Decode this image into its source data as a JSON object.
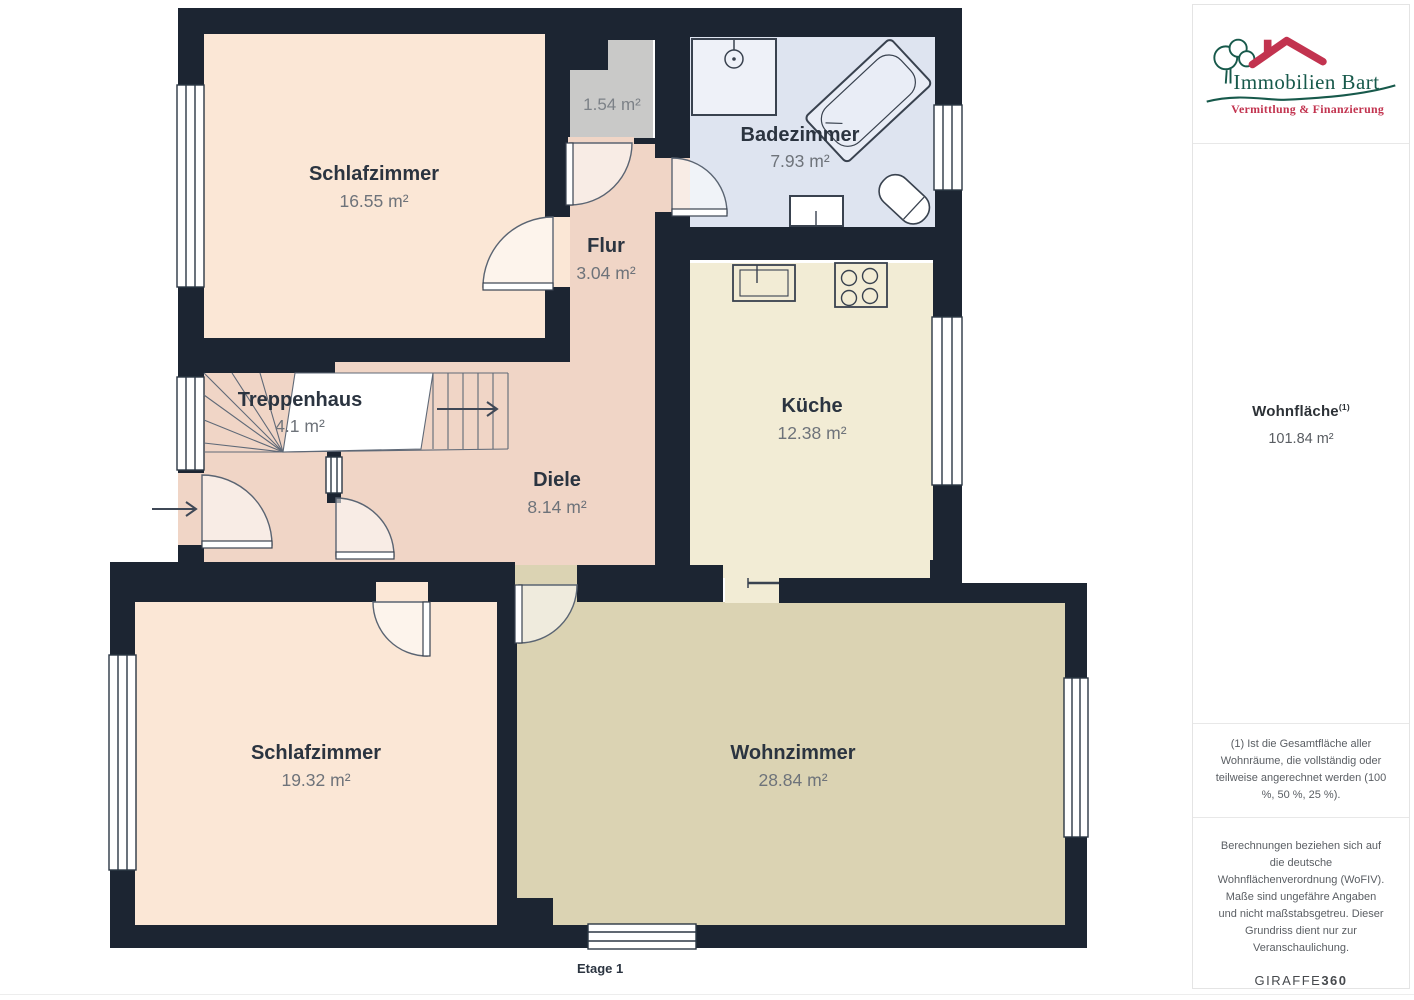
{
  "floorplan": {
    "floor_label": "Etage 1",
    "rooms": [
      {
        "name": "Schlafzimmer",
        "area": "16.55 m²"
      },
      {
        "name": "Badezimmer",
        "area": "7.93 m²"
      },
      {
        "name": "Flur",
        "area": "3.04 m²"
      },
      {
        "name": "Treppenhaus",
        "area": "4.1 m²"
      },
      {
        "name": "Diele",
        "area": "8.14 m²"
      },
      {
        "name": "Küche",
        "area": "12.38 m²"
      },
      {
        "name": "Schlafzimmer",
        "area": "19.32 m²"
      },
      {
        "name": "Wohnzimmer",
        "area": "28.84 m²"
      },
      {
        "name": "",
        "area": "1.54 m²"
      }
    ],
    "colors": {
      "wall": "#1c2532",
      "bedroom_floor": "#fbe7d6",
      "hallway_floor": "#f0d5c6",
      "bathroom_floor": "#dee4f0",
      "kitchen_floor": "#f2ecd5",
      "living_floor": "#dbd3b3",
      "storage_floor": "#c9c9c8"
    }
  },
  "sidebar": {
    "logo": {
      "brand": "Immobilien Bart",
      "tagline": "Vermittlung & Finanzierung",
      "brand_color": "#17594b",
      "accent_color": "#c2334f"
    },
    "summary": {
      "label": "Wohnfläche",
      "superscript": "(1)",
      "value": "101.84 m²"
    },
    "footnote_area": "(1) Ist die Gesamtfläche aller Wohnräume, die vollständig oder teilweise angerechnet werden (100 %, 50 %, 25 %).",
    "footnote_disclaimer": "Berechnungen beziehen sich auf die deutsche Wohnflächenverordnung (WoFIV). Maße sind ungefähre Angaben und nicht maßstabsgetreu. Dieser Grundriss dient nur zur Veranschaulichung.",
    "brand_footer": {
      "name": "GIRAFFE",
      "suffix": "360"
    }
  }
}
